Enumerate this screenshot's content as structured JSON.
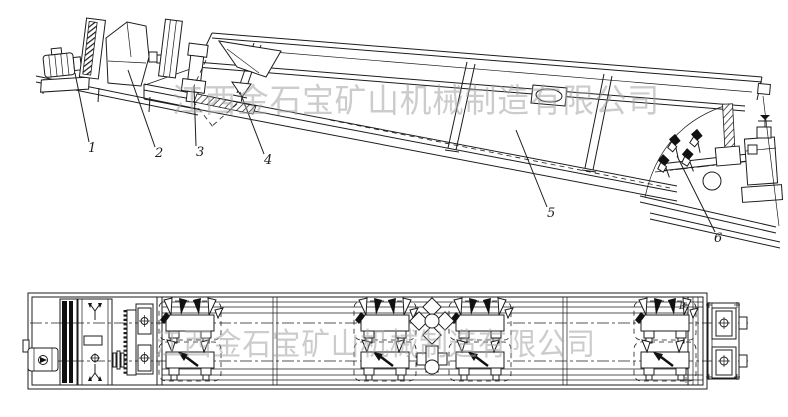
{
  "watermark": {
    "text": "江西金石宝矿山机械制造有限公司",
    "color": "#a3a3a3"
  },
  "side_view": {
    "callouts": [
      "1",
      "2",
      "3",
      "4",
      "5",
      "6"
    ]
  },
  "plan_view": {
    "section_label": "B"
  },
  "colors": {
    "line": "#1c1c1c",
    "background": "#ffffff"
  }
}
